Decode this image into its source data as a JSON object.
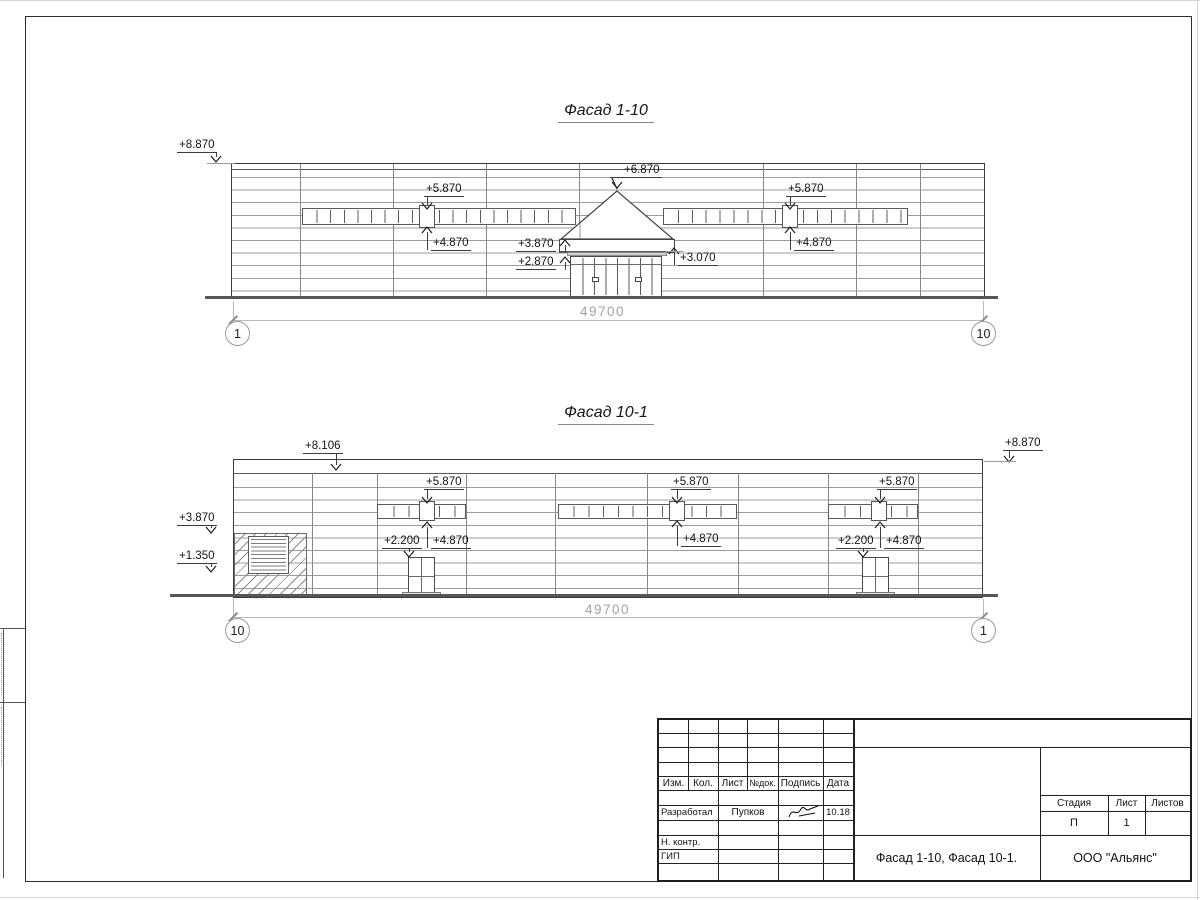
{
  "sheet": {
    "facade1": {
      "title": "Фасад 1-10",
      "dimension": "49700",
      "axis_left": "1",
      "axis_right": "10",
      "marks": {
        "roof_left": "+8.870",
        "win_left_top": "+5.870",
        "win_left_bottom": "+4.870",
        "apex": "+6.870",
        "canopy_top": "+3.870",
        "canopy_bottom": "+2.870",
        "entry_right": "+3.070",
        "win_right_top": "+5.870",
        "win_right_bottom": "+4.870"
      }
    },
    "facade2": {
      "title": "Фасад 10-1",
      "dimension": "49700",
      "axis_left": "10",
      "axis_right": "1",
      "marks": {
        "roof_left": "+8.106",
        "roof_right": "+8.870",
        "dock_top": "+3.870",
        "dock_bottom": "+1.350",
        "strip1_top": "+5.870",
        "strip1_door": "+2.200",
        "strip1_bottom": "+4.870",
        "strip2_top": "+5.870",
        "strip2_bottom": "+4.870",
        "strip3_top": "+5.870",
        "strip3_door": "+2.200",
        "strip3_bottom": "+4.870"
      }
    },
    "titleblock": {
      "col_izm": "Изм.",
      "col_kol": "Кол.",
      "col_list": "Лист",
      "col_ndok": "№док.",
      "col_podpis": "Подпись",
      "col_data": "Дата",
      "row_developed_label": "Разработал",
      "row_developed_name": "Пупков",
      "row_developed_date": "10.18",
      "row_ncontr_label": "Н. контр.",
      "row_gip_label": "ГИП",
      "doc_title": "Фасад 1-10, Фасад 10-1.",
      "company": "ООО \"Альянс\"",
      "stage_label": "Стадия",
      "sheet_label": "Лист",
      "sheets_label": "Листов",
      "stage_value": "П",
      "sheet_value": "1"
    }
  }
}
